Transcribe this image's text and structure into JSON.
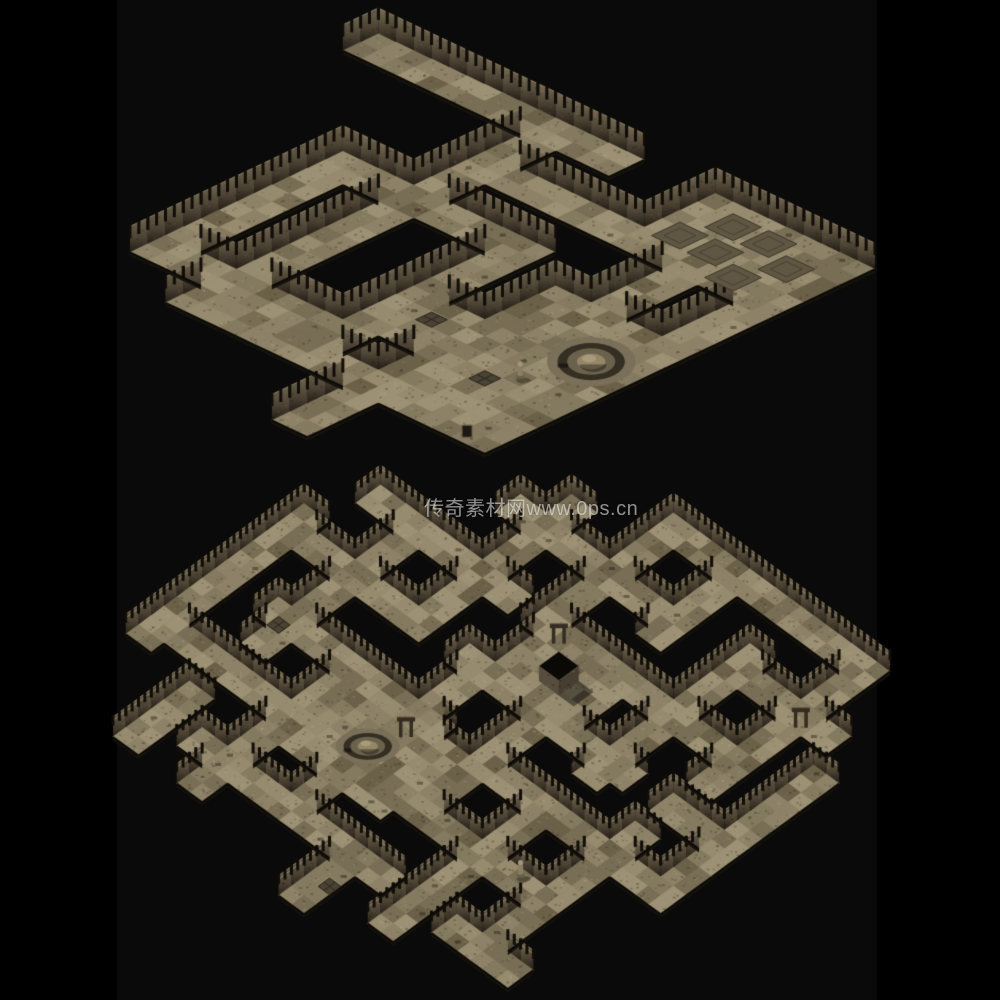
{
  "page": {
    "width": 1000,
    "height": 1000,
    "background": "#000000",
    "image_band": {
      "x": 117,
      "width": 760,
      "color": "#0a0a0a"
    }
  },
  "watermark": {
    "text": "传奇素材网www.0ps.cn",
    "x": 424,
    "y": 492,
    "font_size": 20,
    "color": "rgba(255,255,255,0.55)"
  },
  "palette": {
    "floor_tones": [
      "#8d8267",
      "#968b6e",
      "#847a5f",
      "#9c9174",
      "#786e55"
    ],
    "floor_patch": "#6b6149",
    "wall_light": "#6f6450",
    "wall_light_ne": "#7a6e57",
    "wall_mid": "#4a4132",
    "wall_dark": "#1d1811",
    "wall_top_edge": "#8a7e64",
    "rail": "#94886b",
    "post": "#100d08",
    "rim": "#0c0a07",
    "cliff": "#17130d",
    "rug": "#5f5743",
    "rug_border": "#3e382b",
    "fountain_outer": "#7a7059",
    "fountain_ring": "#342e23",
    "fountain_basin": "#6b624d",
    "fountain_dome": "#948768",
    "fountain_highlight": "#a89b7b",
    "block_face_sw": "#564d3d",
    "block_face_se": "#463e31",
    "block_top": "#0b0906",
    "arch": "#332c21",
    "arch_light": "#6b5f4a",
    "statue": "#8a7e64",
    "statue_head": "#a1957a",
    "statue_base": "#6a6049",
    "grate": "#4a4335",
    "grate_line": "#2a251b",
    "door": "#1d1812"
  },
  "maps": [
    {
      "name": "upper-dungeon-map",
      "description": "Isometric stone dungeon: interlocking diagonal corridors with palisade walls, top-right room with dark rugs, bottom-right room with round fountain, bottom-left cross corridor",
      "seed": 7,
      "wall_height": 26,
      "wall_style": "palisade",
      "screen_rect": {
        "x": 130,
        "y": 8,
        "w": 745,
        "h": 452
      },
      "grid": {
        "cols": 30,
        "rows": 26
      },
      "floor_rects": [
        [
          2,
          0,
          16,
          1
        ],
        [
          12,
          0,
          13,
          21
        ],
        [
          14,
          4,
          25,
          5
        ],
        [
          8,
          8,
          19,
          9
        ],
        [
          8,
          8,
          9,
          19
        ],
        [
          8,
          18,
          19,
          19
        ],
        [
          18,
          8,
          19,
          19
        ],
        [
          24,
          2,
          25,
          19
        ],
        [
          21,
          0,
          29,
          5
        ],
        [
          28,
          6,
          29,
          9
        ],
        [
          22,
          10,
          29,
          19
        ],
        [
          20,
          14,
          21,
          17
        ],
        [
          22,
          14,
          23,
          25
        ],
        [
          14,
          20,
          21,
          21
        ],
        [
          24,
          20,
          29,
          21
        ]
      ],
      "features": [
        {
          "type": "fountain",
          "c": 27,
          "r": 13
        },
        {
          "type": "rug",
          "c": 23,
          "r": 1
        },
        {
          "type": "rug",
          "c": 25,
          "r": 1
        },
        {
          "type": "rug",
          "c": 27,
          "r": 2
        },
        {
          "type": "rug",
          "c": 24,
          "r": 3
        },
        {
          "type": "rug",
          "c": 26,
          "r": 4
        },
        {
          "type": "rug",
          "c": 22,
          "r": 3
        },
        {
          "type": "statue",
          "c": 26,
          "r": 16
        },
        {
          "type": "grate",
          "c": 25,
          "r": 17
        },
        {
          "type": "grate",
          "c": 20,
          "r": 15
        },
        {
          "type": "door",
          "c": 28,
          "r": 21
        }
      ]
    },
    {
      "name": "lower-dungeon-map",
      "description": "Isometric maze dungeon: dense lattice of narrow fenced corridors with black voids, fountain plaza left of center, raised black-topped block platform near center",
      "seed": 13,
      "wall_height": 20,
      "wall_style": "fence",
      "screen_rect": {
        "x": 113,
        "y": 465,
        "w": 777,
        "h": 530
      },
      "grid": {
        "cols": 36,
        "rows": 36
      },
      "floor_rects": [
        [
          16,
          0,
          29,
          1
        ],
        [
          8,
          5,
          21,
          6
        ],
        [
          26,
          5,
          33,
          6
        ],
        [
          2,
          10,
          13,
          11
        ],
        [
          18,
          10,
          31,
          11
        ],
        [
          0,
          15,
          9,
          16
        ],
        [
          14,
          15,
          27,
          16
        ],
        [
          30,
          15,
          35,
          16
        ],
        [
          4,
          20,
          17,
          21
        ],
        [
          22,
          20,
          33,
          21
        ],
        [
          0,
          25,
          13,
          26
        ],
        [
          18,
          25,
          29,
          26
        ],
        [
          8,
          30,
          23,
          31
        ],
        [
          28,
          30,
          33,
          31
        ],
        [
          0,
          14,
          1,
          27
        ],
        [
          5,
          10,
          6,
          23
        ],
        [
          5,
          28,
          6,
          33
        ],
        [
          10,
          3,
          11,
          16
        ],
        [
          10,
          20,
          11,
          33
        ],
        [
          15,
          0,
          16,
          11
        ],
        [
          15,
          16,
          16,
          29
        ],
        [
          20,
          0,
          21,
          7
        ],
        [
          20,
          12,
          21,
          25
        ],
        [
          20,
          30,
          21,
          35
        ],
        [
          25,
          4,
          26,
          17
        ],
        [
          25,
          22,
          26,
          33
        ],
        [
          30,
          0,
          31,
          13
        ],
        [
          30,
          18,
          31,
          29
        ],
        [
          34,
          8,
          35,
          21
        ],
        [
          12,
          21,
          19,
          27
        ],
        [
          16,
          10,
          22,
          16
        ]
      ],
      "features": [
        {
          "type": "fountain",
          "c": 15,
          "r": 24
        },
        {
          "type": "block",
          "c": 19,
          "r": 13
        },
        {
          "type": "arch",
          "c": 17,
          "r": 11
        },
        {
          "type": "arch",
          "c": 16,
          "r": 22
        },
        {
          "type": "arch",
          "c": 31,
          "r": 6
        },
        {
          "type": "grate",
          "c": 5,
          "r": 21
        },
        {
          "type": "statue",
          "c": 28,
          "r": 25
        },
        {
          "type": "grate",
          "c": 21,
          "r": 33
        }
      ]
    }
  ]
}
